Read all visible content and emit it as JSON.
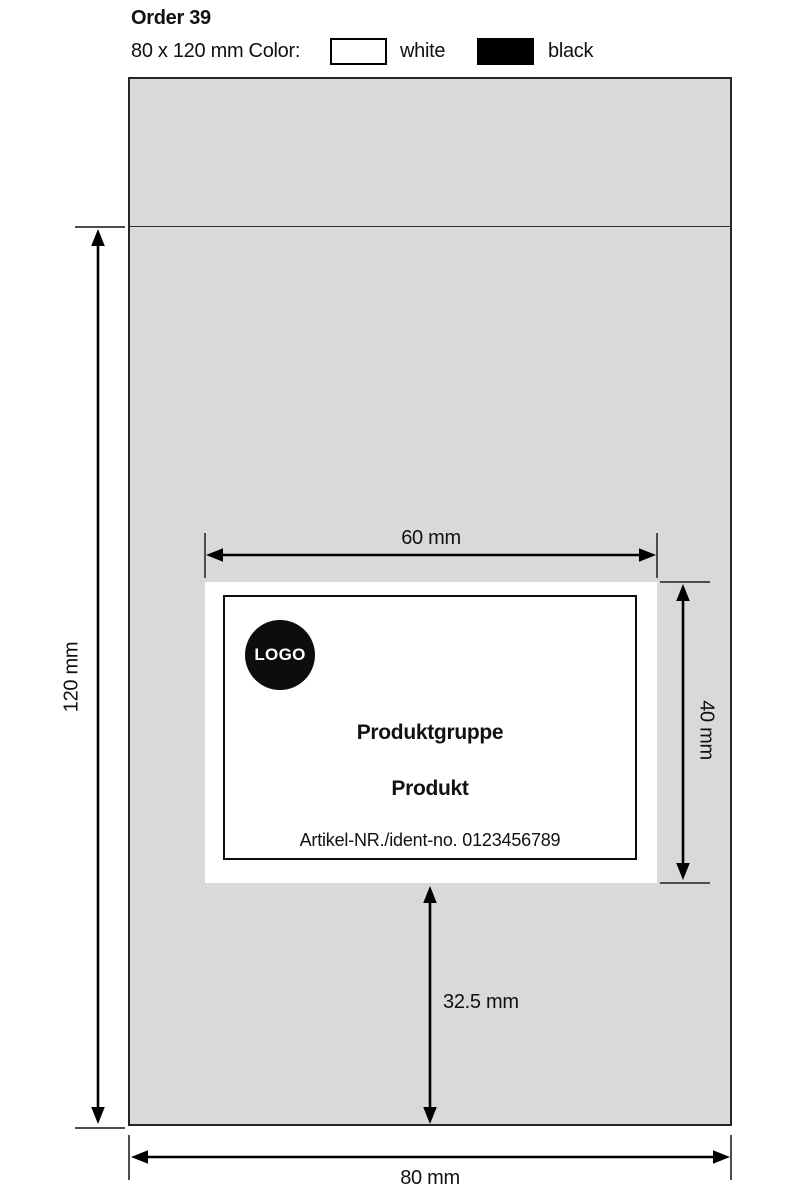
{
  "header": {
    "order_title": "Order 39",
    "size_color_label": "80 x 120 mm Color:",
    "swatches": [
      {
        "label": "white",
        "color": "#ffffff"
      },
      {
        "label": "black",
        "color": "#000000"
      }
    ]
  },
  "bag": {
    "fill_color": "#d9d9d9",
    "outline_color": "#262626",
    "label_fill_color": "#ffffff"
  },
  "label": {
    "logo_text": "LOGO",
    "product_group": "Produktgruppe",
    "product_name": "Produkt",
    "article_line": "Artikel-NR./ident-no. 0123456789"
  },
  "dimensions": {
    "label_width": "60 mm",
    "label_height": "40 mm",
    "label_bottom_offset": "32.5 mm",
    "bag_width": "80 mm",
    "bag_height": "120 mm"
  }
}
